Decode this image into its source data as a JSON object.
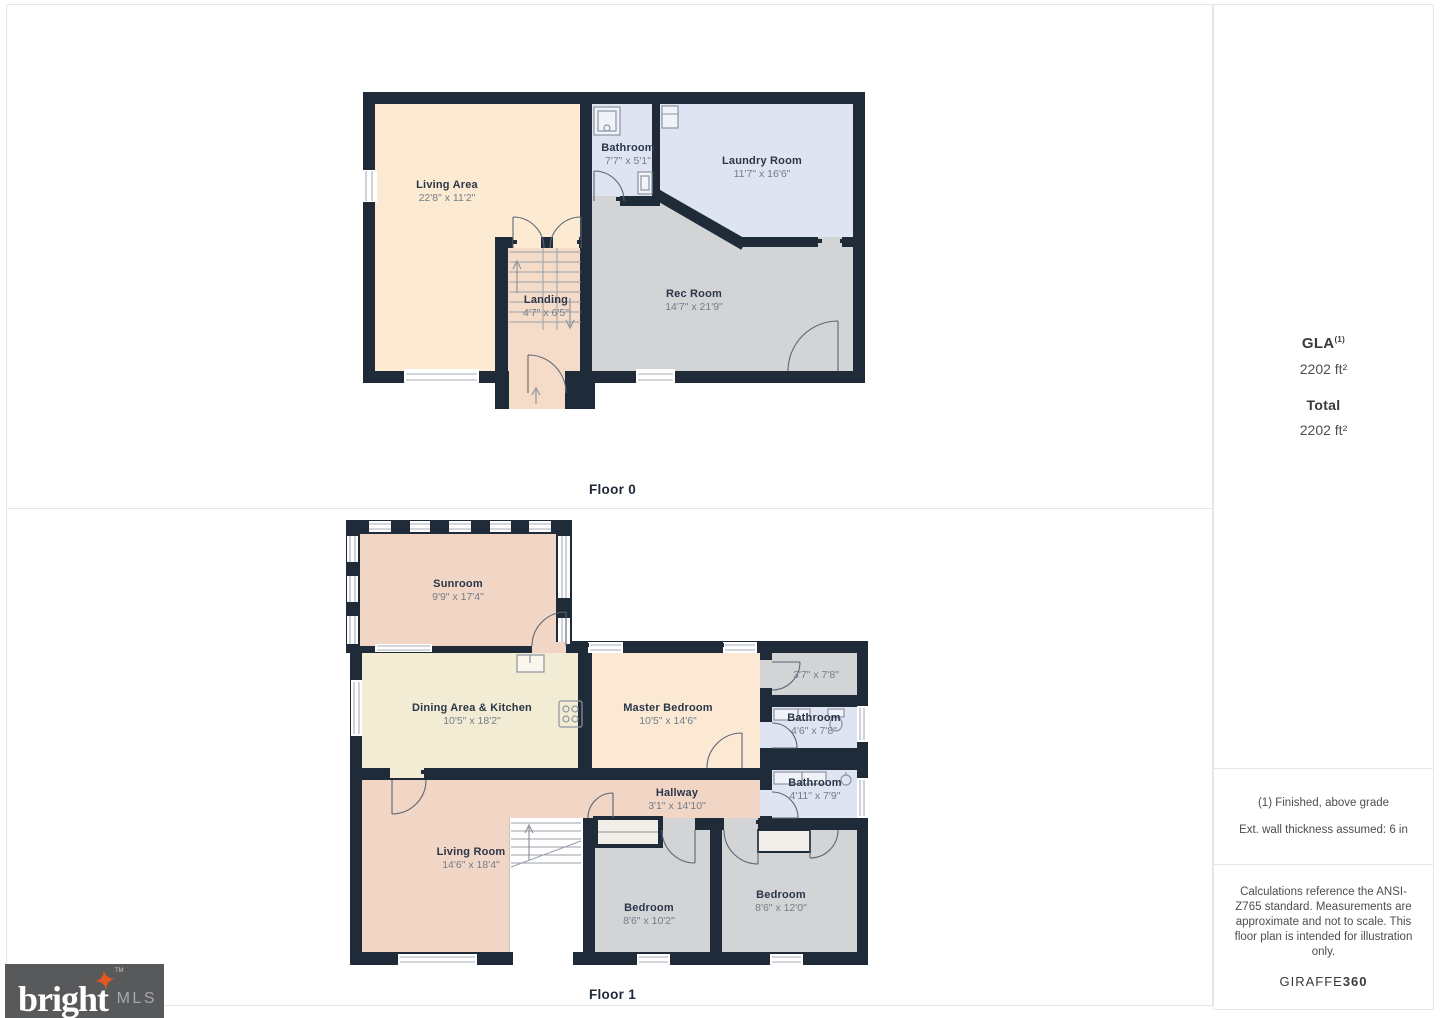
{
  "floor0": {
    "label": "Floor 0",
    "rooms": [
      {
        "name": "Living Area",
        "dims": "22'8\" x 11'2\""
      },
      {
        "name": "Bathroom",
        "dims": "7'7\" x 5'1\""
      },
      {
        "name": "Laundry Room",
        "dims": "11'7\" x 16'6\""
      },
      {
        "name": "Landing",
        "dims": "4'7\" x 6'5\""
      },
      {
        "name": "Rec Room",
        "dims": "14'7\" x 21'9\""
      }
    ]
  },
  "floor1": {
    "label": "Floor 1",
    "rooms": [
      {
        "name": "Sunroom",
        "dims": "9'9\" x 17'4\""
      },
      {
        "name": "Dining Area & Kitchen",
        "dims": "10'5\" x 18'2\""
      },
      {
        "name": "Master Bedroom",
        "dims": "10'5\" x 14'6\""
      },
      {
        "name": "",
        "dims": "3'7\" x 7'8\""
      },
      {
        "name": "Bathroom",
        "dims": "4'6\" x 7'8\""
      },
      {
        "name": "Bathroom",
        "dims": "4'11\" x 7'9\""
      },
      {
        "name": "Hallway",
        "dims": "3'1\" x 14'10\""
      },
      {
        "name": "Living Room",
        "dims": "14'6\" x 18'4\""
      },
      {
        "name": "Bedroom",
        "dims": "8'6\" x 10'2\""
      },
      {
        "name": "Bedroom",
        "dims": "8'6\" x 12'0\""
      }
    ]
  },
  "sidebar": {
    "gla_label": "GLA",
    "gla_sup": "(1)",
    "gla_value": "2202 ft²",
    "total_label": "Total",
    "total_value": "2202 ft²",
    "footnote_finished": "(1) Finished, above grade",
    "footnote_wall": "Ext. wall thickness assumed: 6 in",
    "disclaimer": "Calculations reference the ANSI-Z765 standard. Measurements are approximate and not to scale. This floor plan is intended for illustration only.",
    "brand_name": "GIRAFFE",
    "brand_suffix": "360"
  },
  "logo": {
    "brand": "bright",
    "suffix": "MLS",
    "tm": "TM"
  },
  "colors": {
    "wall": "#1f2b39",
    "living_area": "#fcebd2",
    "bathroom_laundry": "#dee4f1",
    "rec_room_bedrooms": "#d3d4d6",
    "landing": "#f4dcc8",
    "sunroom_living": "#f1d6c5",
    "dining_kitchen": "#f3ecd4",
    "master_bedroom": "#fbe9d4",
    "logo_bg": "#58595b",
    "logo_star": "#e2571f"
  }
}
